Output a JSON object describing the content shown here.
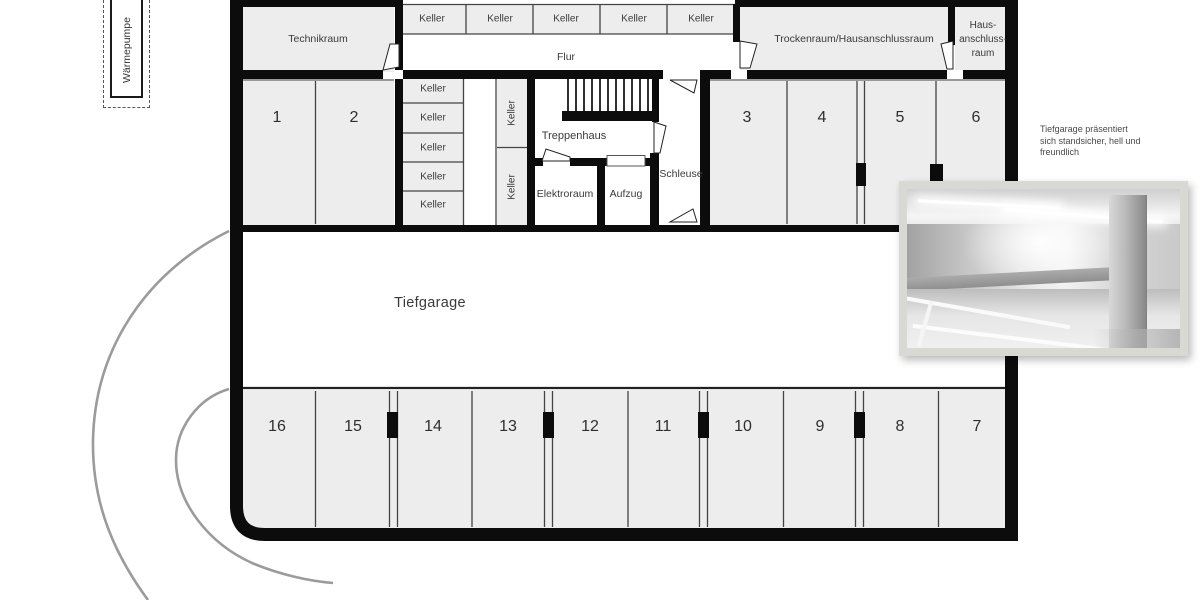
{
  "colors": {
    "wall": "#0c0c0c",
    "room_fill": "#ededed",
    "thin_line": "#444444",
    "driveway_arc": "#9b9b9b",
    "text": "#3a3a3a",
    "photo_frame": "#d8d8d4"
  },
  "annex": {
    "warmepumpe": "Wärmepumpe"
  },
  "top_band": {
    "technikraum": "Technikraum",
    "keller_row": [
      "Keller",
      "Keller",
      "Keller",
      "Keller",
      "Keller"
    ],
    "flur": "Flur",
    "trockenraum": "Trockenraum/Hausanschlussraum",
    "hausanschluss_lines": [
      "Haus-",
      "anschluss-",
      "raum"
    ]
  },
  "core": {
    "keller_stack": [
      "Keller",
      "Keller",
      "Keller",
      "Keller",
      "Keller"
    ],
    "keller_side": [
      "Keller",
      "Keller"
    ],
    "treppenhaus": "Treppenhaus",
    "elektroraum": "Elektroraum",
    "aufzug": "Aufzug",
    "schleuse": "Schleuse"
  },
  "garage": {
    "label": "Tiefgarage",
    "upper_spaces": [
      "1",
      "2",
      "3",
      "4",
      "5",
      "6"
    ],
    "lower_spaces": [
      "16",
      "15",
      "14",
      "13",
      "12",
      "11",
      "10",
      "9",
      "8",
      "7"
    ]
  },
  "photo_caption": {
    "lines": [
      "Tiefgarage präsentiert",
      "sich standsicher, hell und",
      "freundlich"
    ]
  },
  "photo_inset": {
    "content": "underground-garage-photo"
  }
}
